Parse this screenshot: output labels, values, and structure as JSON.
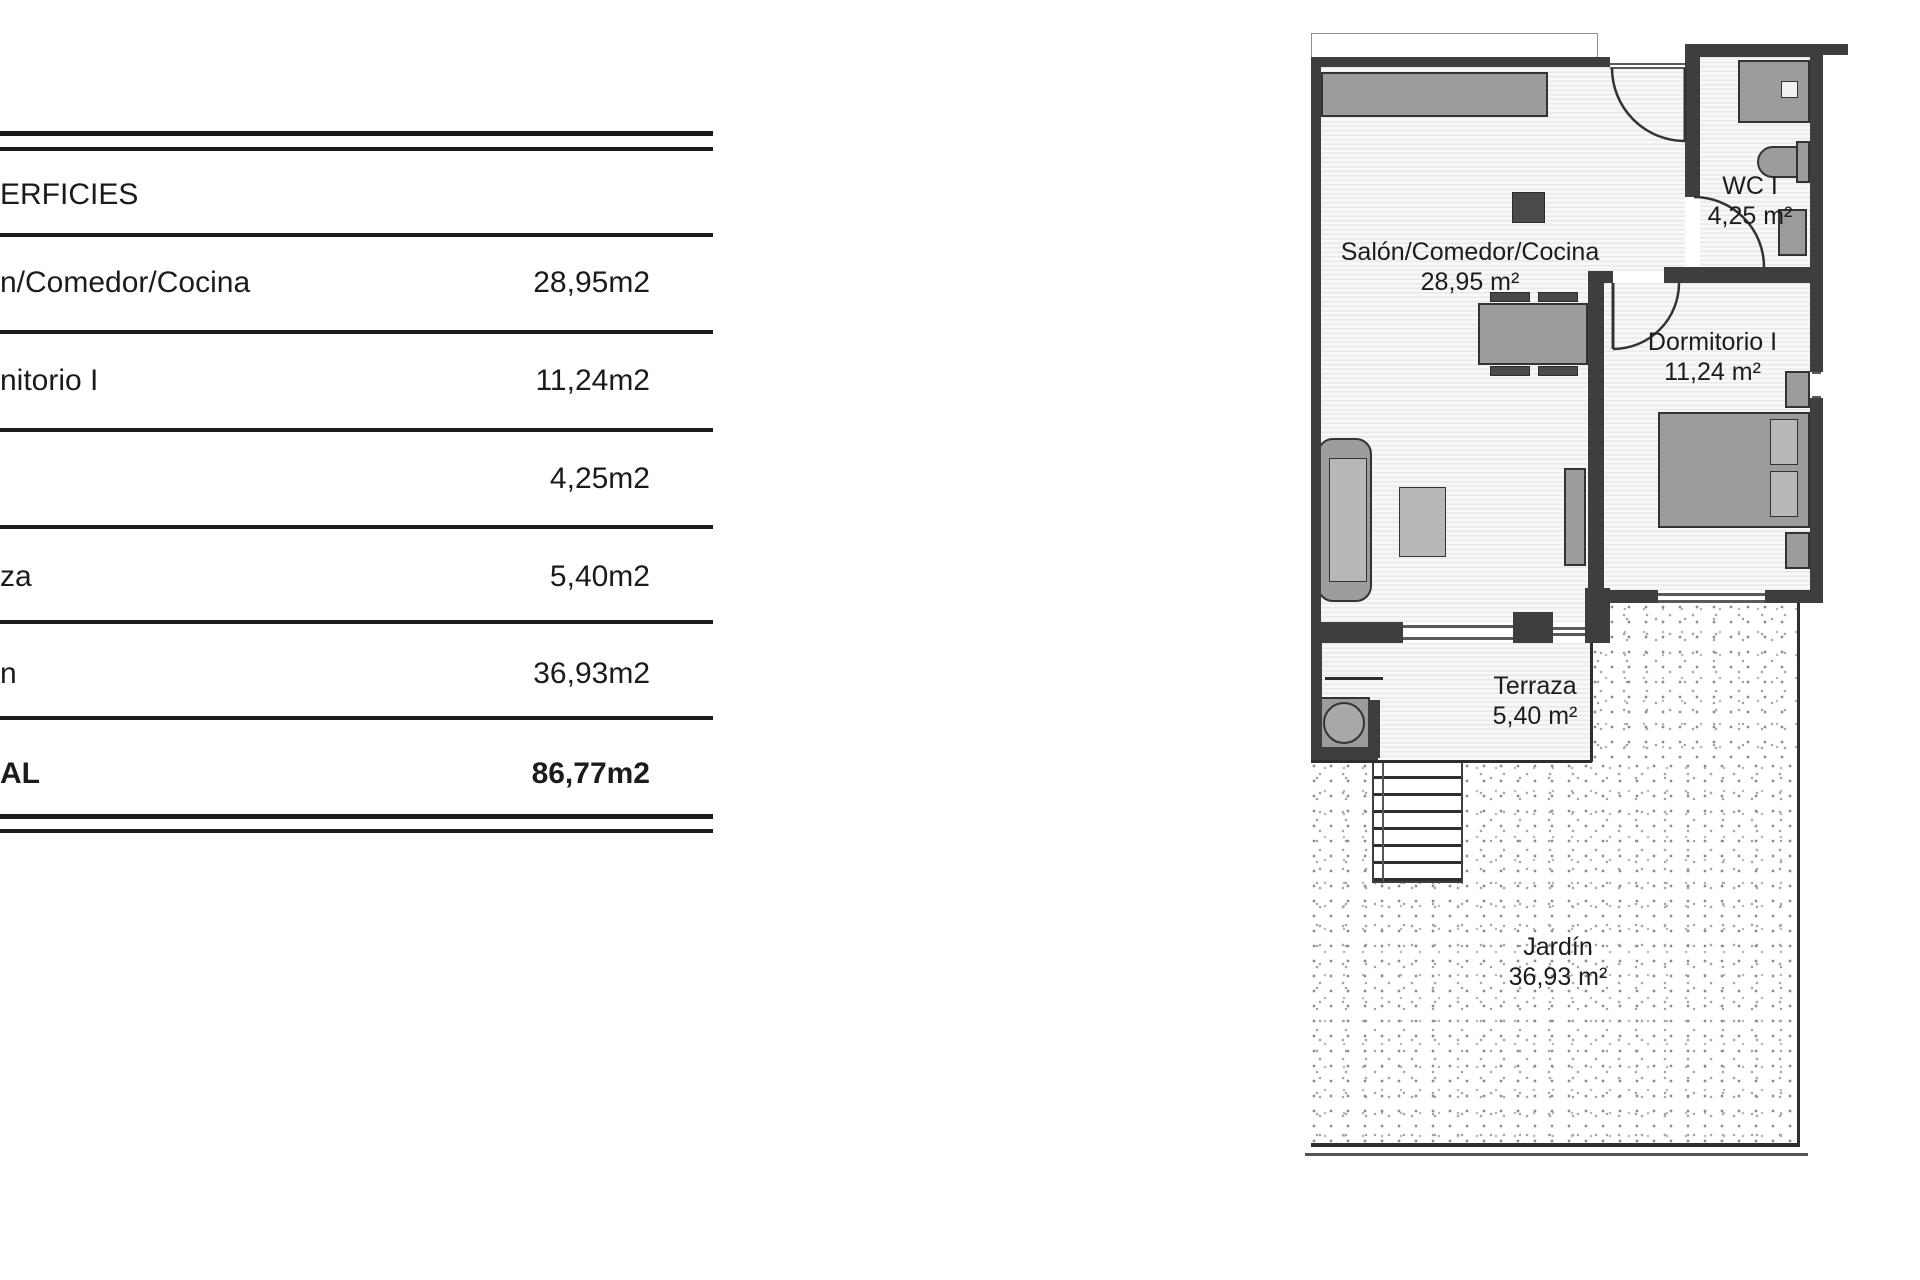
{
  "table": {
    "header": "ERFICIES",
    "rows": [
      {
        "label": "n/Comedor/Cocina",
        "value": "28,95m2"
      },
      {
        "label": "nitorio I",
        "value": "11,24m2"
      },
      {
        "label": "",
        "value": "4,25m2"
      },
      {
        "label": "za",
        "value": "5,40m2"
      },
      {
        "label": "n",
        "value": "36,93m2"
      },
      {
        "label": "AL",
        "value": "86,77m2"
      }
    ]
  },
  "plan": {
    "rooms": {
      "salon": {
        "label": "Salón/Comedor/Cocina",
        "area": "28,95 m²"
      },
      "wc": {
        "label": "WC I",
        "area": "4,25 m²"
      },
      "dormitorio": {
        "label": "Dormitorio I",
        "area": "11,24 m²"
      },
      "terraza": {
        "label": "Terraza",
        "area": "5,40 m²"
      },
      "jardin": {
        "label": "Jardín",
        "area": "36,93 m²"
      }
    }
  },
  "colors": {
    "wall": "#3e3e3e",
    "line": "#1b1b1b",
    "furniture": "#9c9c9c"
  }
}
